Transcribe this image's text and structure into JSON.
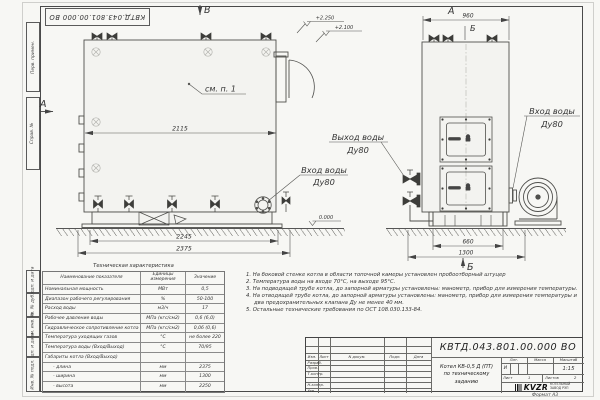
{
  "sheet": {
    "code": "КВТД.043.801.00.000 ВО",
    "format_label": "Формат А3"
  },
  "frame_left": {
    "items": [
      "Перв. примен.",
      "Справ. №",
      "Подп. и дата",
      "Инв. № дубл.",
      "Взам. инв. №",
      "Подп. и дата",
      "Инв. № подл."
    ]
  },
  "views": {
    "side": {
      "label_v": "В",
      "label_a": "А",
      "note_ref": "см. п. 1",
      "dim_width": "2115",
      "dim_base": "2245",
      "dim_total": "2375",
      "elev_1": "+2.250",
      "elev_2": "+2.100",
      "elev_zero": "0.000",
      "inlet_line1": "Вход воды",
      "inlet_line2": "Ду80"
    },
    "front": {
      "label_a": "А",
      "dim_top": "960",
      "label_b_top": "Б",
      "label_b_bottom": "Б",
      "dim_base": "660",
      "dim_total": "1300",
      "outlet_line1": "Выход воды",
      "outlet_line2": "Ду80",
      "inlet_line1": "Вход воды",
      "inlet_line2": "Ду80"
    }
  },
  "tech_table": {
    "title": "Техническая характеристика",
    "headers": [
      "Наименование показателя",
      "Единицы измерения",
      "Значение"
    ],
    "rows": [
      [
        "Номинальная мощность",
        "МВт",
        "0,5"
      ],
      [
        "Диапазон рабочего регулирования",
        "%",
        "50-100"
      ],
      [
        "Расход воды",
        "м3/ч",
        "17"
      ],
      [
        "Рабочее давление воды",
        "МПа (кгс/см2)",
        "0,6 (6,0)"
      ],
      [
        "Гидравлическое сопротивление котла",
        "МПа (кгс/см2)",
        "0,06 (0,6)"
      ],
      [
        "Температура уходящих газов",
        "°С",
        "не более 220"
      ],
      [
        "Температура воды (Вход/Выход)",
        "°С",
        "70/95"
      ],
      [
        "Габариты котла (Вход/Выход)",
        "",
        ""
      ],
      [
        "- длина",
        "мм",
        "2375"
      ],
      [
        "- ширина",
        "мм",
        "1300"
      ],
      [
        "- высота",
        "мм",
        "2250"
      ]
    ]
  },
  "notes": [
    "1.  На боковой стенке котла в области топочной камеры установлен пробоотборный штуцер",
    "2.  Температура воды на входе 70°С, на выходе 95°С.",
    "3.  На подводящей трубе котла, до запорной арматуры установлены: манометр, прибор для измерения температуры.",
    "4.  На отводящей трубе котла, до запорной арматуры установлены: манометр, прибор для измерения температуры и два предохранительных клапана Ду не менее 40 мм.",
    "5.  Остальные технические требования по ОСТ 108.030.133-84."
  ],
  "title_block": {
    "header_cols": [
      "Изм.",
      "Лист",
      "N докум.",
      "Подп.",
      "Дата"
    ],
    "sig_rows": [
      "Разраб.",
      "Пров.",
      "Т.контр.",
      "Н.контр.",
      "Утв."
    ],
    "doc_title_line1": "Котел КВ-0,5 Д (ПТ)",
    "doc_title_line2": "по техническому заданию",
    "lit_header": [
      "Лит.",
      "Масса",
      "Масштаб"
    ],
    "lit_value": "И",
    "scale": "1:15",
    "sheet_label": "Лист",
    "sheet_num": "1",
    "sheets_label": "Листов",
    "sheets_num": "2",
    "logo": "KVZR",
    "org_line1": "КОТЕЛЬНЫЙ",
    "org_line2": "ЗАВОД РЭП"
  }
}
